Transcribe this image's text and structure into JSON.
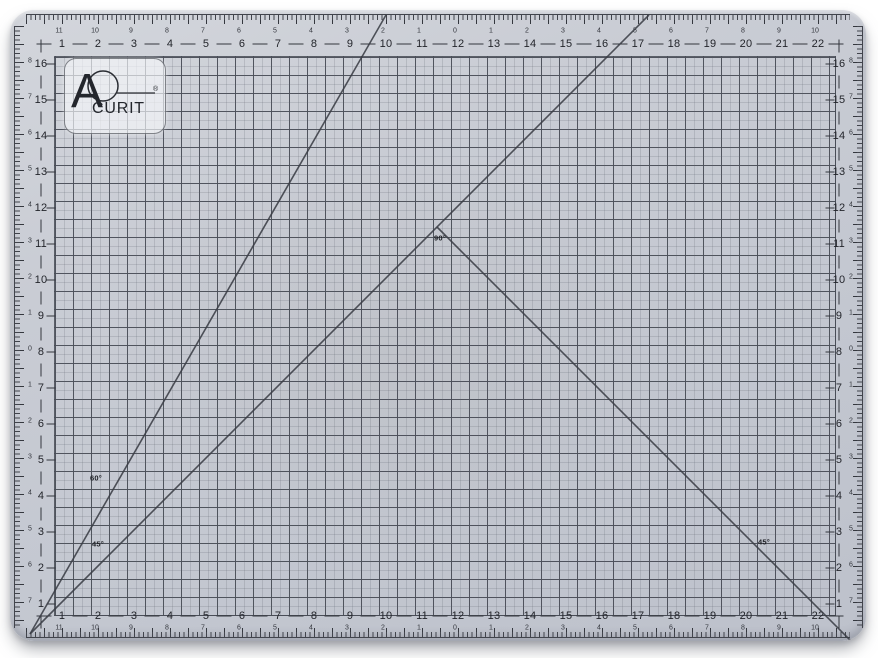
{
  "product": {
    "description": "Acurit translucent self-healing cutting mat, 18 x 24 inch grid, photographed on white background"
  },
  "brand": {
    "name": "ACURIT",
    "letter_a": "A",
    "rest": "CURIT",
    "registered": "®"
  },
  "rulers": {
    "top_main": [
      "1",
      "2",
      "3",
      "4",
      "5",
      "6",
      "7",
      "8",
      "9",
      "10",
      "11",
      "12",
      "13",
      "14",
      "15",
      "16",
      "17",
      "18",
      "19",
      "20",
      "21",
      "22"
    ],
    "top_small": [
      "11",
      "10",
      "9",
      "8",
      "7",
      "6",
      "5",
      "4",
      "3",
      "2",
      "1",
      "0",
      "1",
      "2",
      "3",
      "4",
      "5",
      "6",
      "7",
      "8",
      "9",
      "10"
    ],
    "bottom_main": [
      "1",
      "2",
      "3",
      "4",
      "5",
      "6",
      "7",
      "8",
      "9",
      "10",
      "11",
      "12",
      "13",
      "14",
      "15",
      "16",
      "17",
      "18",
      "19",
      "20",
      "21",
      "22"
    ],
    "bottom_small": [
      "11",
      "10",
      "9",
      "8",
      "7",
      "6",
      "5",
      "4",
      "3",
      "2",
      "1",
      "0",
      "1",
      "2",
      "3",
      "4",
      "5",
      "6",
      "7",
      "8",
      "9",
      "10"
    ],
    "left_main": [
      "16",
      "15",
      "14",
      "13",
      "12",
      "11",
      "10",
      "9",
      "8",
      "7",
      "6",
      "5",
      "4",
      "3",
      "2",
      "1"
    ],
    "left_small": [
      "8",
      "7",
      "6",
      "5",
      "4",
      "3",
      "2",
      "1",
      "0",
      "1",
      "2",
      "3",
      "4",
      "5",
      "6",
      "7"
    ],
    "right_main": [
      "16",
      "15",
      "14",
      "13",
      "12",
      "11",
      "10",
      "9",
      "8",
      "7",
      "6",
      "5",
      "4",
      "3",
      "2",
      "1"
    ],
    "right_small": [
      "8",
      "7",
      "6",
      "5",
      "4",
      "3",
      "2",
      "1",
      "0",
      "1",
      "2",
      "3",
      "4",
      "5",
      "6",
      "7"
    ]
  },
  "angle_labels": {
    "sixty": "60°",
    "fortyfive_left": "45°",
    "ninety": "90°",
    "fortyfive_right": "45°"
  },
  "colors": {
    "mat_surface": "#c6c9d2",
    "grid_line": "#42464f",
    "ruler_text": "#23252b",
    "angle_line": "#3b3e46",
    "plate_fill": "#f5f6f9",
    "background": "#ffffff"
  }
}
